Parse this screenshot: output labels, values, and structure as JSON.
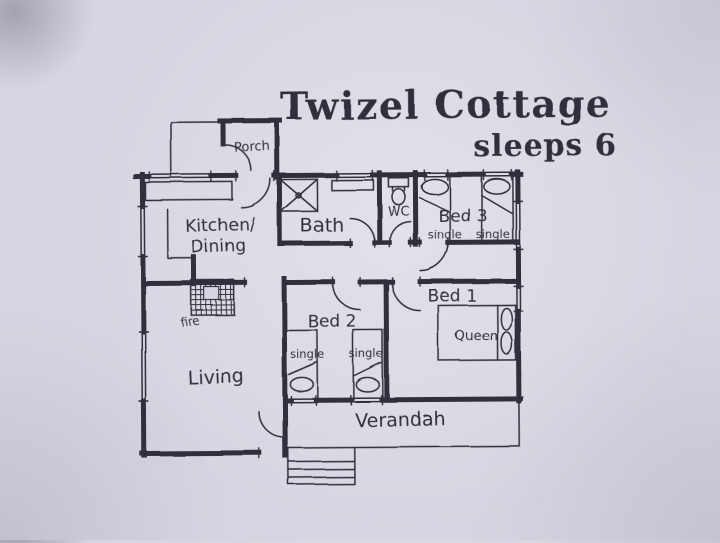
{
  "title": "Twizel Cottage",
  "subtitle": "sleeps 6",
  "rooms": {
    "porch": "Porch",
    "kitchen_line1": "Kitchen/",
    "kitchen_line2": "Dining",
    "bath": "Bath",
    "wc": "WC",
    "bed3": "Bed 3",
    "bed3_left_bed": "single",
    "bed3_right_bed": "single",
    "bed1": "Bed 1",
    "bed1_bed": "Queen",
    "bed2": "Bed 2",
    "bed2_left_bed": "single",
    "bed2_right_bed": "single",
    "living": "Living",
    "fireplace": "fire",
    "verandah": "Verandah"
  },
  "colors": {
    "paper": "#d7d5e1",
    "ink": "#312f3b"
  }
}
